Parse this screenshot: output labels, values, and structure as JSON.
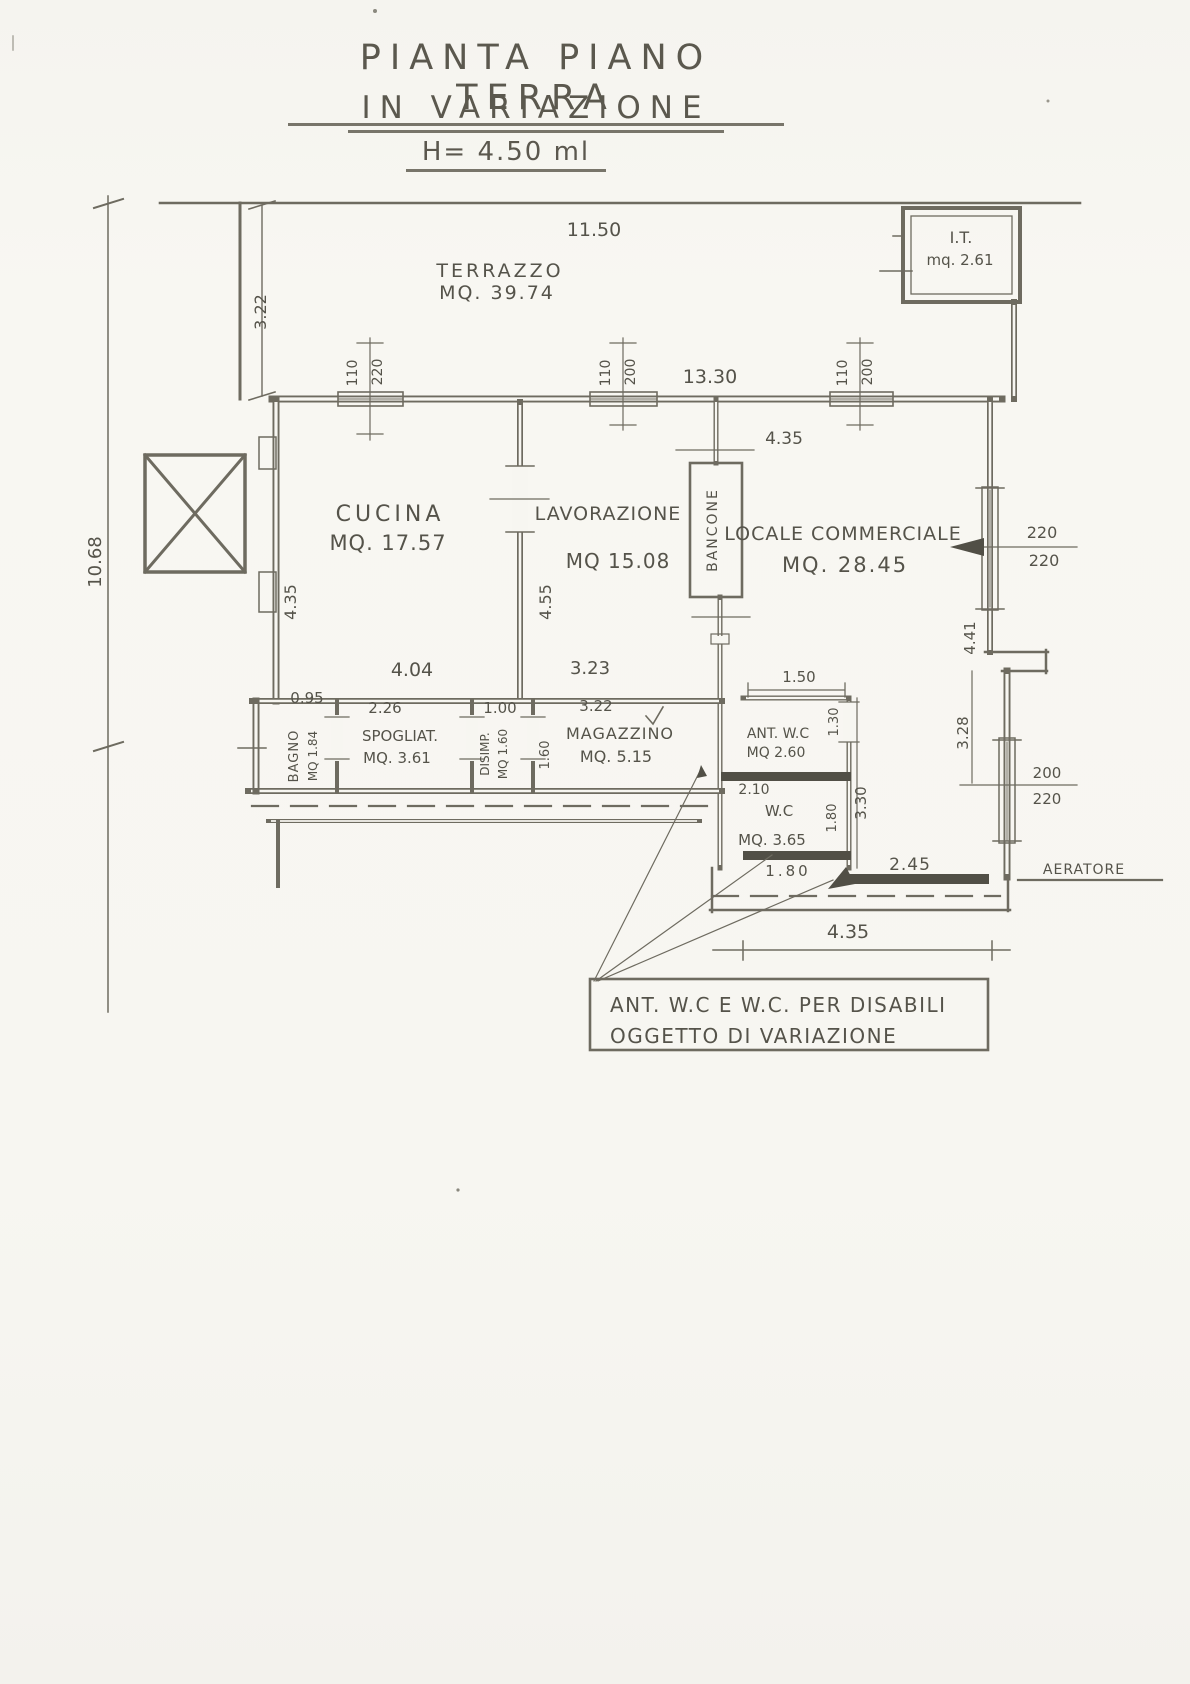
{
  "title": {
    "line1": "PIANTA PIANO TERRA",
    "line2": "IN VARIAZIONE",
    "height_note": "H= 4.50 ml"
  },
  "rooms": {
    "terrazzo": {
      "name": "TERRAZZO",
      "area": "MQ. 39.74"
    },
    "it_cabin": {
      "name": "I.T.",
      "area": "mq. 2.61"
    },
    "cucina": {
      "name": "CUCINA",
      "area": "MQ. 17.57"
    },
    "lavorazione": {
      "name": "LAVORAZIONE",
      "area": "MQ 15.08"
    },
    "bancone": {
      "name": "BANCONE"
    },
    "locale_commerciale": {
      "name": "LOCALE COMMERCIALE",
      "area": "MQ. 28.45"
    },
    "bagno": {
      "name": "BAGNO",
      "area": "MQ 1.84"
    },
    "spogliatoio": {
      "name": "SPOGLIAT.",
      "area": "MQ. 3.61"
    },
    "disimpegno": {
      "name": "DISIMP.",
      "area": "MQ 1.60"
    },
    "magazzino": {
      "name": "MAGAZZINO",
      "area": "MQ. 5.15"
    },
    "ant_wc": {
      "name": "ANT. W.C",
      "area": "MQ 2.60"
    },
    "wc": {
      "name": "W.C",
      "area": "MQ. 3.65"
    },
    "aeratore": "AERATORE"
  },
  "dims": {
    "top_width": "11.50",
    "terrace_depth": "3.22",
    "total_height": "10.68",
    "building_width": "13.30",
    "window1_w": "110",
    "window1_h": "220",
    "window2_w": "110",
    "window2_h": "200",
    "window3_w": "110",
    "window3_h": "200",
    "cucina_height": "4.35",
    "cucina_width": "4.04",
    "lavorazione_height": "4.55",
    "lavorazione_width": "3.23",
    "locale_top": "4.35",
    "locale_height": "4.41",
    "win_right_upper_a": "220",
    "win_right_upper_b": "220",
    "right_lower_height": "3.28",
    "win_right_lower_a": "200",
    "win_right_lower_b": "220",
    "bagno_width": "0.95",
    "spogliatoio_width": "2.26",
    "disimpegno_width": "1.00",
    "disimpegno_depth": "1.60",
    "magazzino_width": "3.22",
    "ant_wc_width": "1.50",
    "ant_wc_door": "1.30",
    "wc_top": "2.10",
    "wc_side": "1.80",
    "wc_bottom": "1.80",
    "wc_height": "3.30",
    "locale_bottom": "2.45",
    "bottom_width": "4.35"
  },
  "note": {
    "line1": "ANT. W.C E W.C. PER DISABILI",
    "line2": "OGGETTO DI VARIAZIONE"
  }
}
